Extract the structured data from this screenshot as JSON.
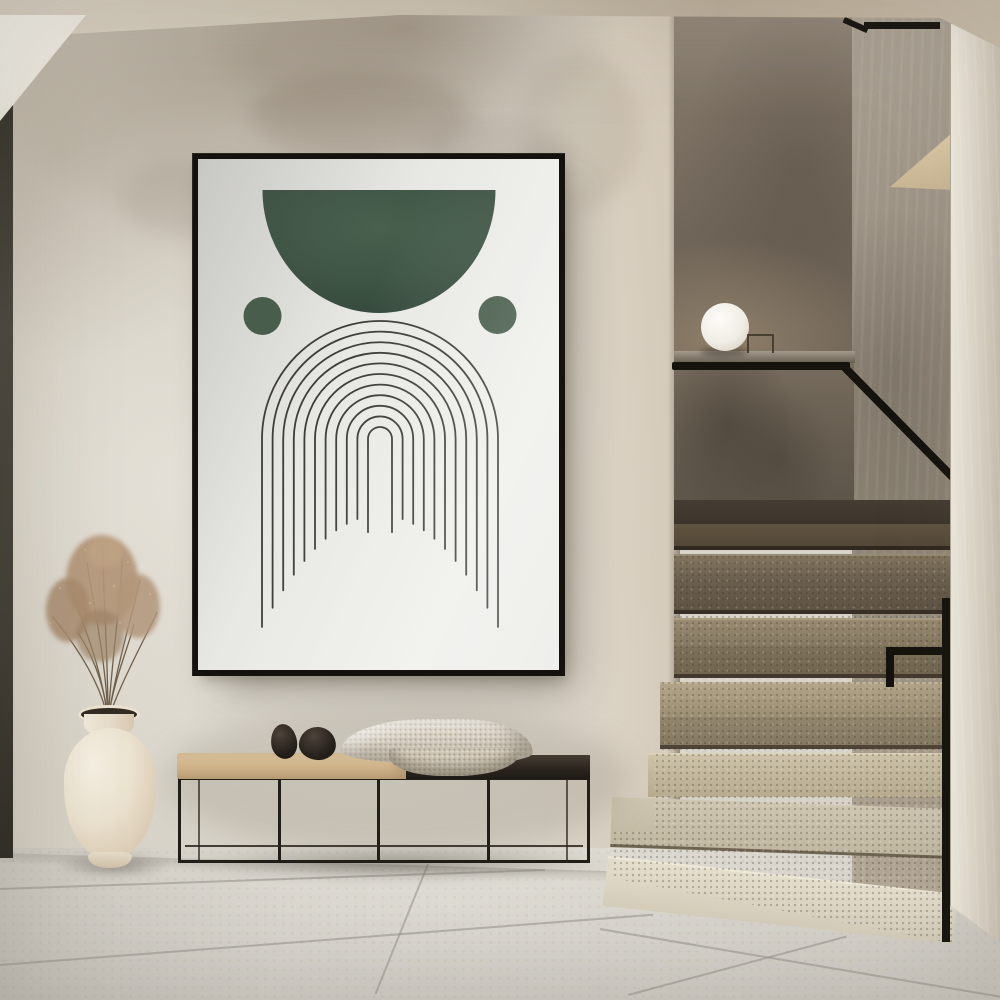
{
  "scene": {
    "setting": "minimalist hallway interior with plaster walls, framed poster, bench and terrazzo staircase",
    "objects": [
      "framed arch line-art poster",
      "black metal bench with tan cushion and dark wood top",
      "two black decorative stones",
      "woven beige cloth",
      "ivory vase with dried grass",
      "white sphere lamp on half-wall ledge",
      "terrazzo staircase",
      "black metal handrail",
      "large-format tiled floor"
    ]
  },
  "poster": {
    "frame_color": "#15120e",
    "paper_color": "#e9e8e4",
    "line_color": "#3e3c37",
    "shape_color": "#3e5343",
    "dot_color": "#465c4a",
    "green_light": "#48604e",
    "green_mid": "#3e5444",
    "green_dark": "#32473a",
    "arch_count": 11,
    "outer_radius": 118,
    "spacing": 10.6,
    "center_x": 182,
    "center_y": 280,
    "leg_base_y": 356,
    "leg_drop": 112,
    "inner_leg_extra": 16,
    "line_width": 1.8,
    "dome": {
      "cx": 181,
      "top_y": 31,
      "rx": 116.5,
      "ry": 123
    },
    "dots": [
      {
        "cx": 64.5,
        "cy": 157,
        "r": 19
      },
      {
        "cx": 299.5,
        "cy": 156,
        "r": 19
      }
    ]
  },
  "palette": {
    "wall": "#d9d4c9",
    "wall_mottle": "#8d7c66",
    "ceiling": "#c9bfad",
    "soffit": "#f1eee6",
    "left_edge": "#3f3c33",
    "floor": "#d5d1c9",
    "floor_joint": "#989489",
    "alcove_wall_dark": "#6e6457",
    "alcove_wall_side": "#978d7f",
    "step_dark": "#554a3a",
    "step_light": "#ded7c6",
    "handrail": "#16130e",
    "bench_metal": "#211e19",
    "cushion": "#d2b68d",
    "bench_dark_top": "#2a241d",
    "stone": "#1d1813",
    "cloth": "#d6cec0",
    "vase": "#ebe2d0",
    "dried_grass": "#b3967a",
    "lamp": "#f7f5ef",
    "wood_wedge": "#d5c2a0"
  }
}
